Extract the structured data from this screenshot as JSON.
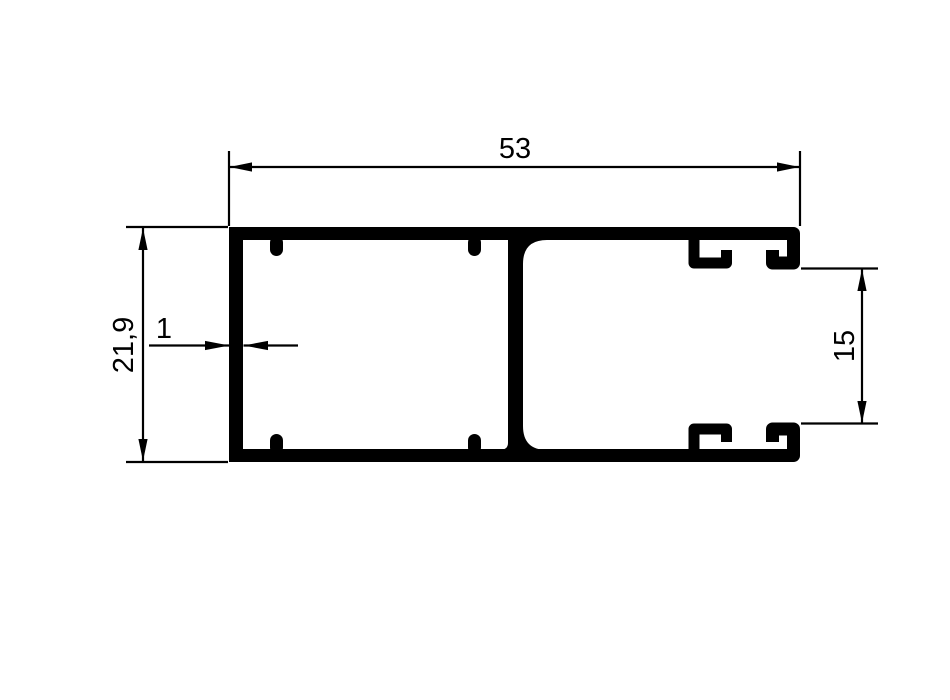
{
  "drawing": {
    "background_color": "#ffffff",
    "line_color": "#000000",
    "dimensions": {
      "overall_width": "53",
      "overall_height": "21,9",
      "wall_thickness": "1",
      "channel_height": "15"
    }
  }
}
